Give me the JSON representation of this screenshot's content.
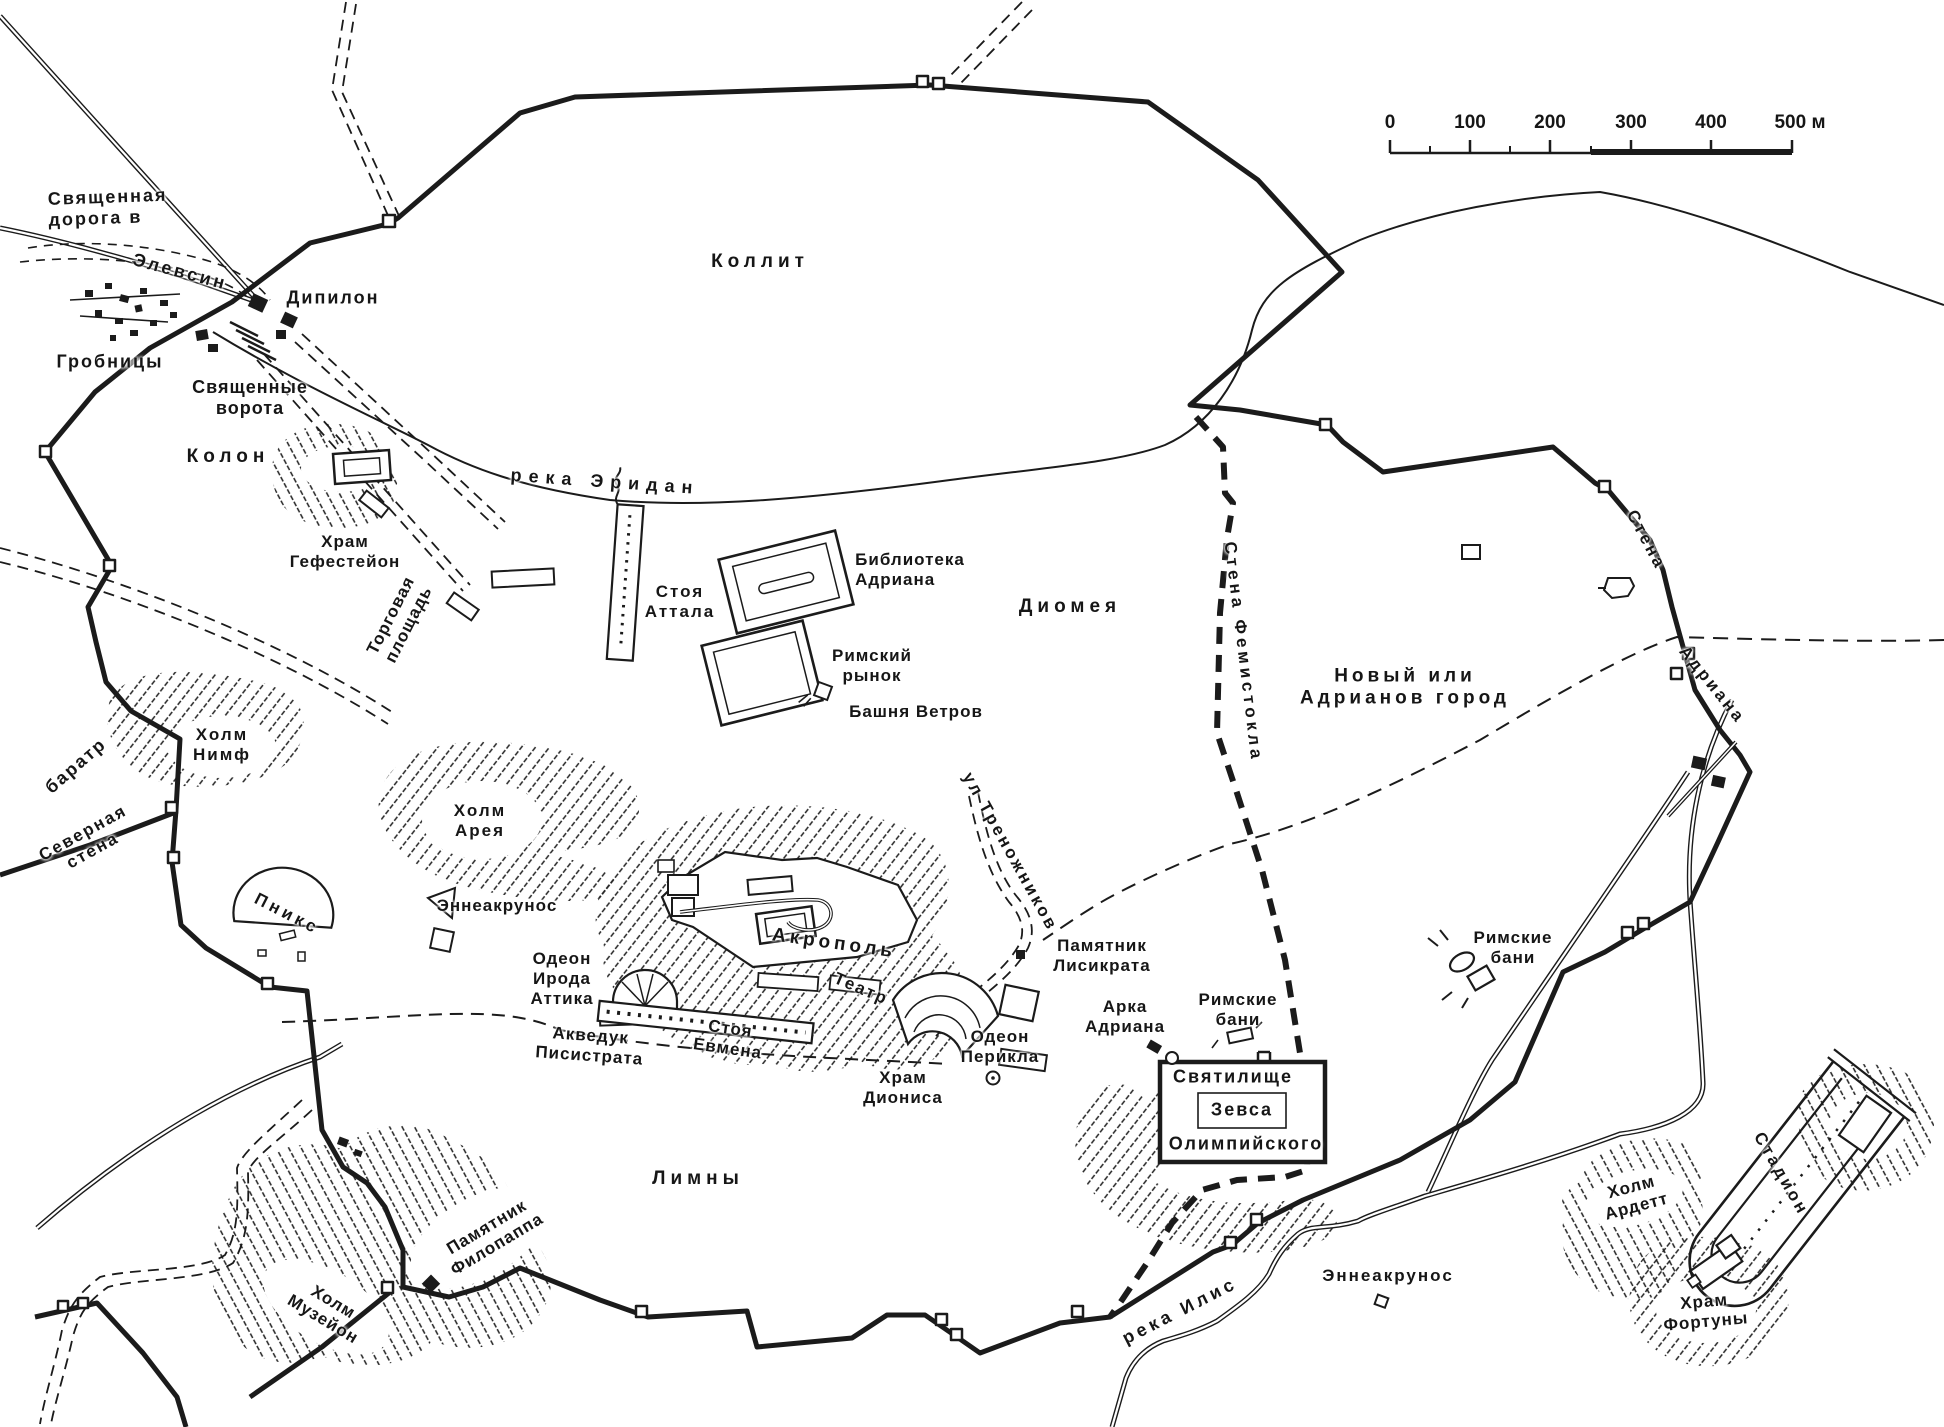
{
  "map": {
    "title": "План древних Афин",
    "ink_color": "#1b1b1b",
    "background_color": "#ffffff",
    "labels": {
      "sacred_road": "Священная\nдорога в",
      "eleusis": "Элевсин",
      "dipylon": "Дипилон",
      "tombs": "Гробницы",
      "sacred_gates": "Священные\nворота",
      "kolon": "Колон",
      "kollit": "Коллит",
      "eridan_river": "река Эридан",
      "hephaisteion": "Храм\nГефестейон",
      "trade_square": "Торговая\nплощадь",
      "stoa_attala": "Стоя\nАттала",
      "hadrian_library": "Библиотека\nАдриана",
      "roman_market": "Римский\nрынок",
      "tower_of_winds": "Башня Ветров",
      "diomea": "Диомея",
      "themistocles_wall": "Стена Фемистокла",
      "new_city": "Новый или\nАдрианов город",
      "wall_word": "Стена",
      "hadriana_word": "Адриана",
      "roman_baths_east": "Римские\nбани",
      "baratr": "баратр",
      "nymph_hill": "Холм\nНимф",
      "north_wall": "Северная\nстена",
      "pnyx": "Пникс",
      "ares_hill": "Холм\nАрея",
      "enneakrunos_west": "Эннеакрунос",
      "odeon_herodes": "Одеон\nИрода\nАттика",
      "acropolis": "Акрополь",
      "theatre": "Театр",
      "stoa_eumenes": "Стоя\nЕвмена",
      "aqueduct": "Акведук\nПисистрата",
      "dionysus_temple": "Храм\nДиониса",
      "tripods_street": "ул Треножников",
      "lysicrates_monument": "Памятник\nЛисикрата",
      "odeon_pericles": "Одеон\nПерикла",
      "hadrian_arch": "Арка\nАдриана",
      "roman_baths_zeus": "Римские\nбани",
      "sanctuary_line1": "Святилище",
      "sanctuary_line2": "Зевса",
      "sanctuary_line3": "Олимпийского",
      "limny": "Лимны",
      "philopappos_monument": "Памятник\nФилопаппа",
      "museion_hill": "Холм\nМузейон",
      "ilis_river": "река Илис",
      "enneakrunos_south": "Эннеакрунос",
      "ardett_hill": "Холм\nАрдетт",
      "stadium": "Стадион",
      "fortuna_temple": "Храм\nФортуны"
    },
    "scale_bar": {
      "ticks": [
        "0",
        "100",
        "200",
        "300",
        "400",
        "500 м"
      ]
    }
  }
}
